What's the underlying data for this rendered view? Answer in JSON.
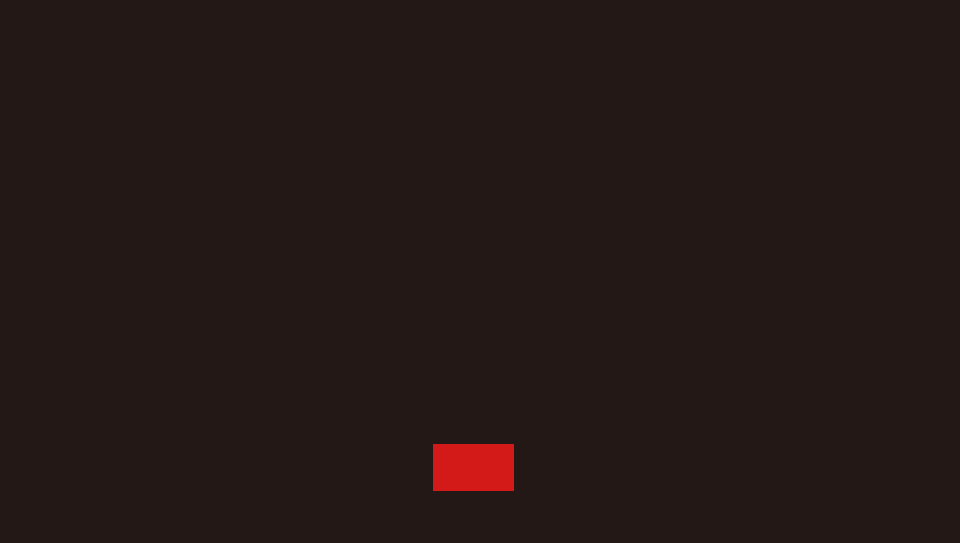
{
  "screen": {
    "background_color": "#231815"
  },
  "red_rectangle": {
    "color": "#d41a18",
    "left": 433,
    "top": 444,
    "width": 81,
    "height": 47
  }
}
